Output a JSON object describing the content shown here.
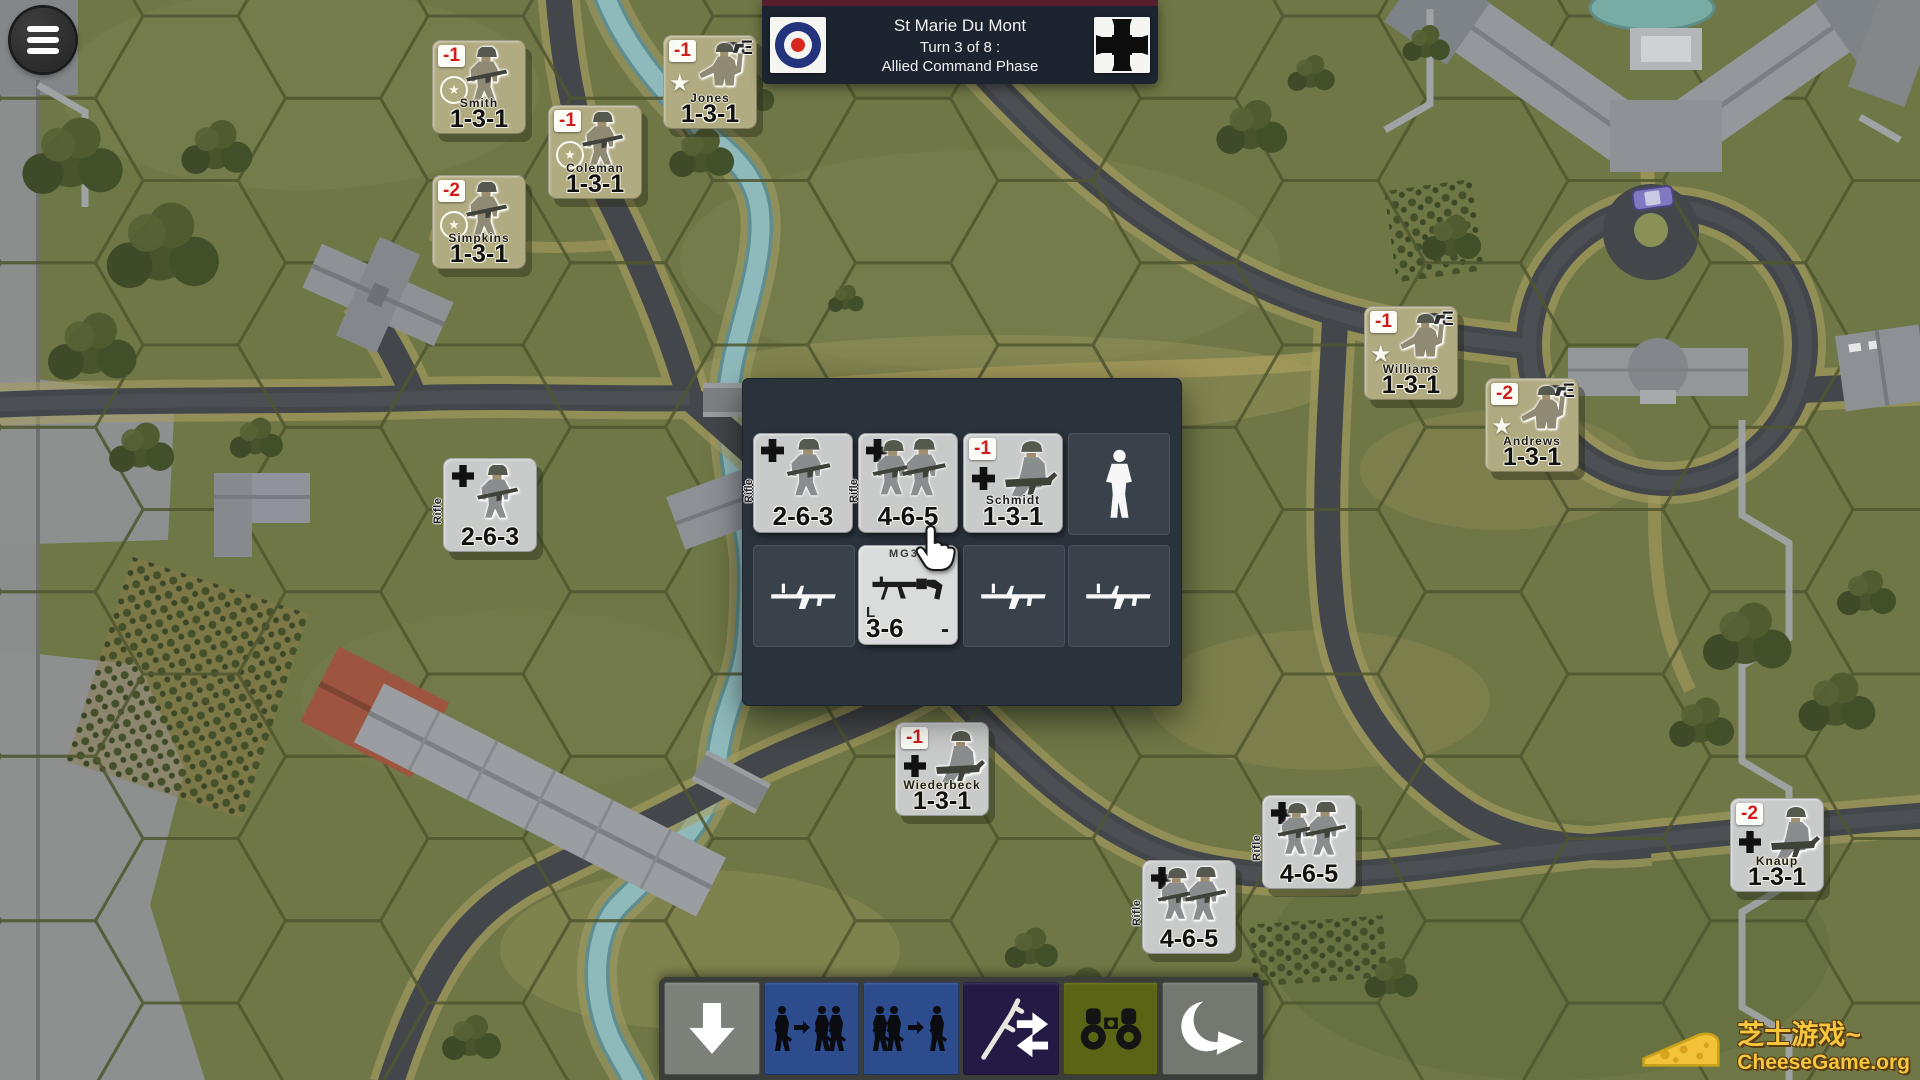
{
  "header": {
    "title": "St Marie Du Mont",
    "turn": "Turn 3 of 8 :",
    "phase": "Allied Command Phase"
  },
  "units": {
    "smith": {
      "name": "Smith",
      "stats": "1-3-1",
      "modifier": "-1"
    },
    "coleman": {
      "name": "Coleman",
      "stats": "1-3-1",
      "modifier": "-1"
    },
    "simpkins": {
      "name": "Simpkins",
      "stats": "1-3-1",
      "modifier": "-2"
    },
    "jones": {
      "name": "Jones",
      "stats": "1-3-1",
      "modifier": "-1",
      "badge": "E"
    },
    "williams": {
      "name": "Williams",
      "stats": "1-3-1",
      "modifier": "-1",
      "badge": "E"
    },
    "andrews": {
      "name": "Andrews",
      "stats": "1-3-1",
      "modifier": "-2",
      "badge": "E"
    },
    "wiederbeck": {
      "name": "Wiederbeck",
      "stats": "1-3-1",
      "modifier": "-1"
    },
    "knaup": {
      "name": "Knaup",
      "stats": "1-3-1",
      "modifier": "-2"
    },
    "rifle_263": {
      "type": "Rifle",
      "stats": "2-6-3"
    },
    "rifle_465_a": {
      "type": "Rifle",
      "stats": "4-6-5"
    },
    "rifle_465_b": {
      "type": "Rifle",
      "stats": "4-6-5"
    }
  },
  "stack_panel": {
    "units": [
      {
        "type": "Rifle",
        "stats": "2-6-3"
      },
      {
        "type": "Rifle",
        "stats": "4-6-5"
      },
      {
        "name": "Schmidt",
        "stats": "1-3-1",
        "modifier": "-1"
      }
    ],
    "weapons": [
      {
        "name": "MG34",
        "wclass": "L",
        "stats": "3-6",
        "ammo": "-"
      }
    ]
  },
  "toolbar": {
    "icons": [
      "down-arrow",
      "stack-join",
      "stack-split",
      "swap-weapons",
      "binoculars",
      "undo-turn"
    ]
  },
  "colors": {
    "allied_counter": "#b1ab82",
    "german_counter": "#c9cbca",
    "modifier_red": "#cf1c1c",
    "panel": "#2a323b",
    "toolbar_blue": "#2d4c8d",
    "toolbar_purple": "#241a45",
    "toolbar_olive": "#5a6415",
    "watermark_yellow": "#f6c63e"
  },
  "watermark": {
    "line1": "芝士游戏~",
    "line2": "CheeseGame.org"
  }
}
